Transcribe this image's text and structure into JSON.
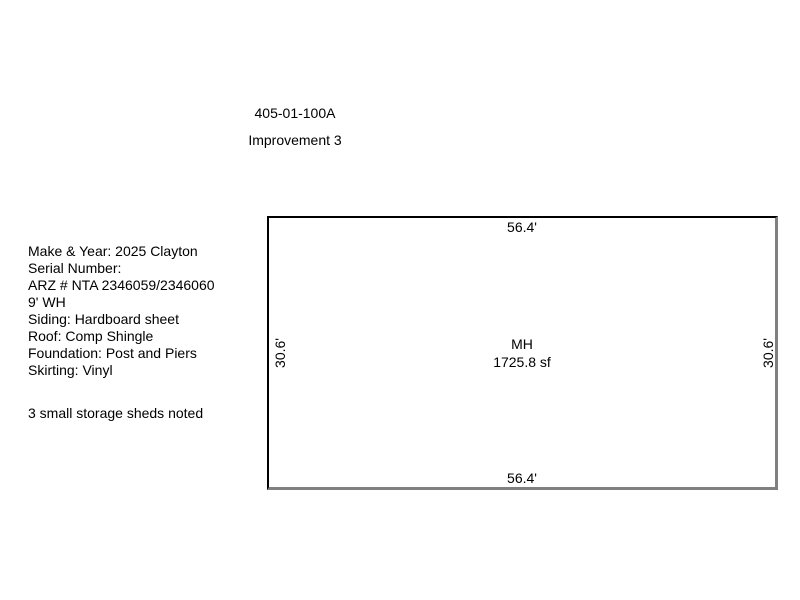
{
  "page": {
    "background_color": "#ffffff",
    "text_color": "#000000"
  },
  "header": {
    "parcel_id": "405-01-100A",
    "improvement_label": "Improvement 3"
  },
  "details": {
    "lines": [
      "Make & Year: 2025 Clayton",
      "Serial Number:",
      "ARZ # NTA 2346059/2346060",
      "9' WH",
      "Siding: Hardboard sheet",
      "Roof: Comp Shingle",
      "Foundation: Post and Piers",
      "Skirting: Vinyl"
    ],
    "note": "3 small storage sheds noted"
  },
  "sketch": {
    "structure_label": "MH",
    "area_label": "1725.8 sf",
    "dimensions": {
      "top": "56.4'",
      "bottom": "56.4'",
      "left": "30.6'",
      "right": "30.6'"
    },
    "border_black_color": "#000000",
    "border_gray_color": "#808080"
  }
}
